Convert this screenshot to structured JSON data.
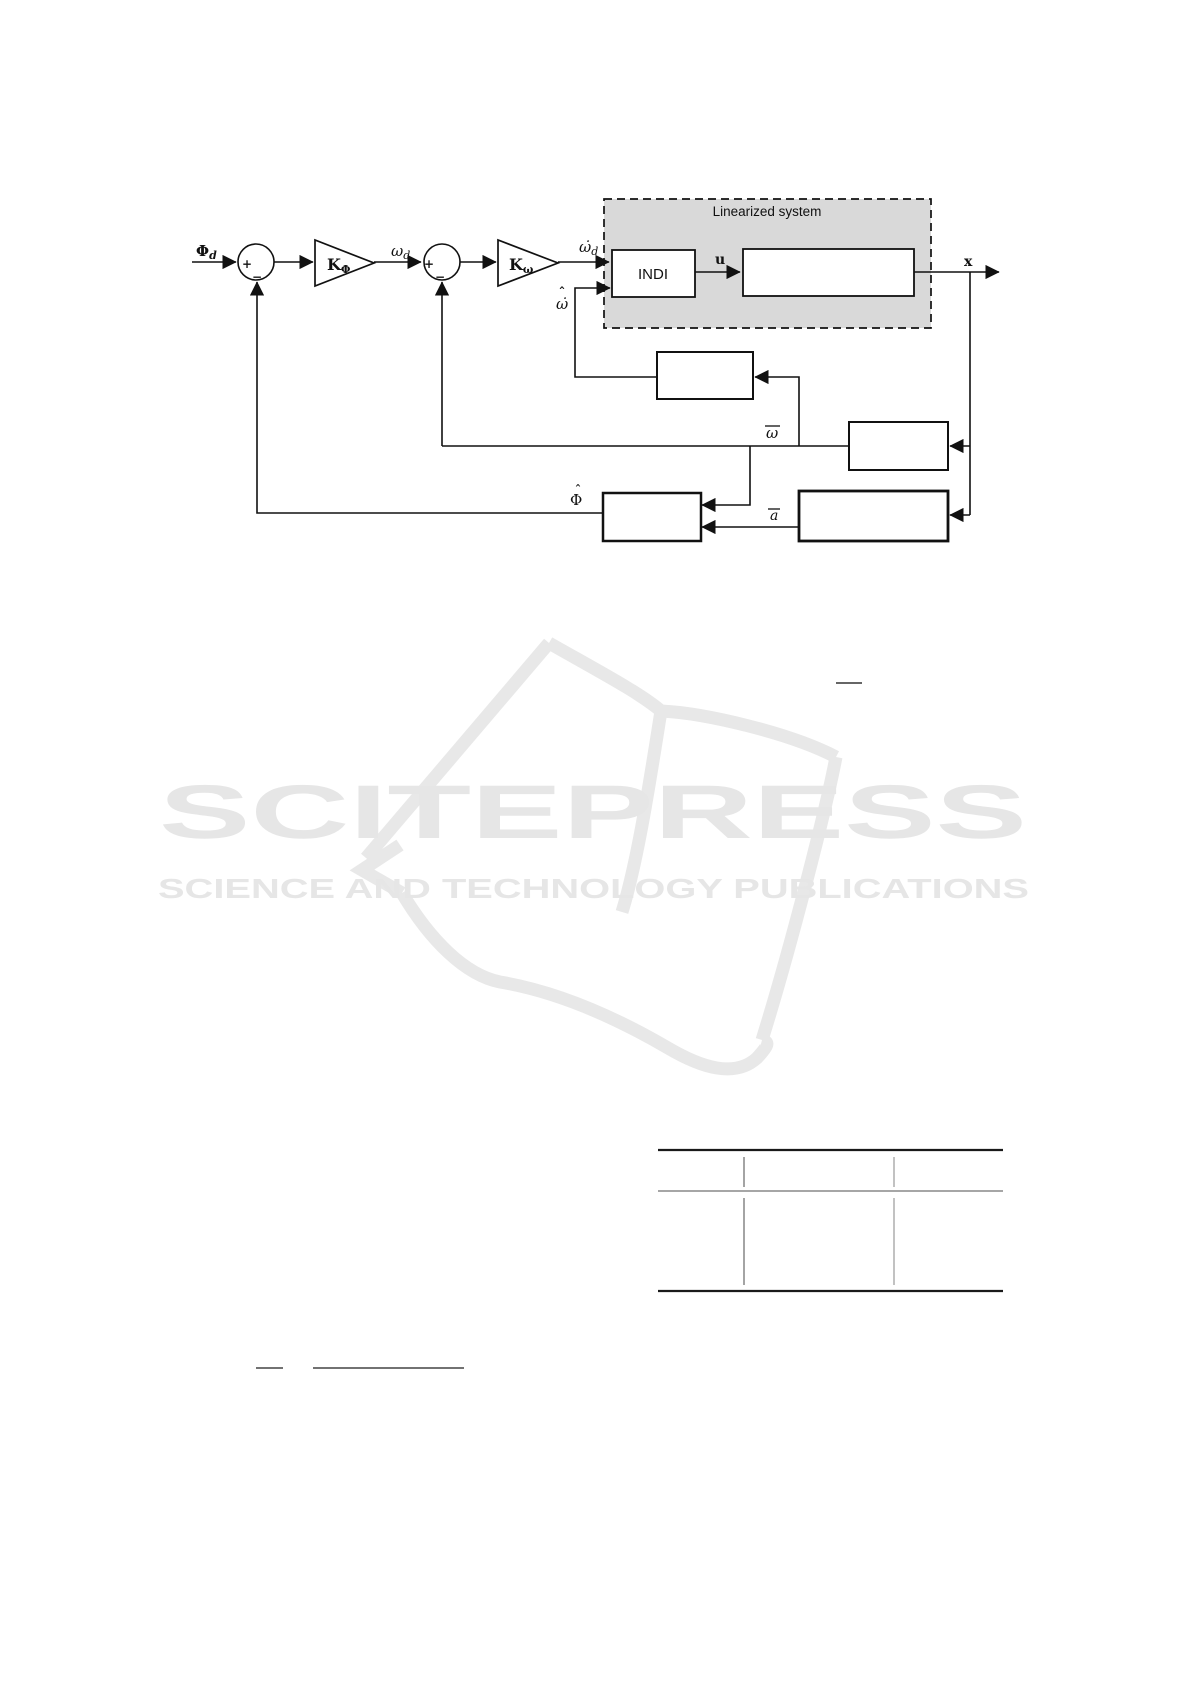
{
  "diagram": {
    "linearized_box_label": "Linearized system",
    "indi_label": "INDI",
    "signals": {
      "phi_d_main": "Φ",
      "phi_d_sub": "d",
      "k_phi_main": "K",
      "k_phi_sub": "Φ",
      "omega_d_main": "ω",
      "omega_d_sub": "d",
      "k_omega_main": "K",
      "k_omega_sub": "ω",
      "omega_dot_d_main": "ω̇",
      "omega_dot_d_sub": "d",
      "omega_hat_accent": "ˆ",
      "omega_hat_main": "ω̇",
      "u_label": "u",
      "x_label": "x",
      "omega_bar_main": "ω",
      "a_bar_main": "a",
      "phi_hat_accent": "ˆ",
      "phi_hat_main": "Φ",
      "plus": "+",
      "minus": "−"
    },
    "colors": {
      "line": "#111111",
      "dashed_box_fill": "#d9d9d9",
      "block_fill": "#ffffff"
    }
  },
  "watermark": {
    "brand": "SCITEPRESS",
    "tagline": "SCIENCE AND TECHNOLOGY PUBLICATIONS",
    "color": "#e6e6e6",
    "book_color": "#e8e8e8"
  }
}
